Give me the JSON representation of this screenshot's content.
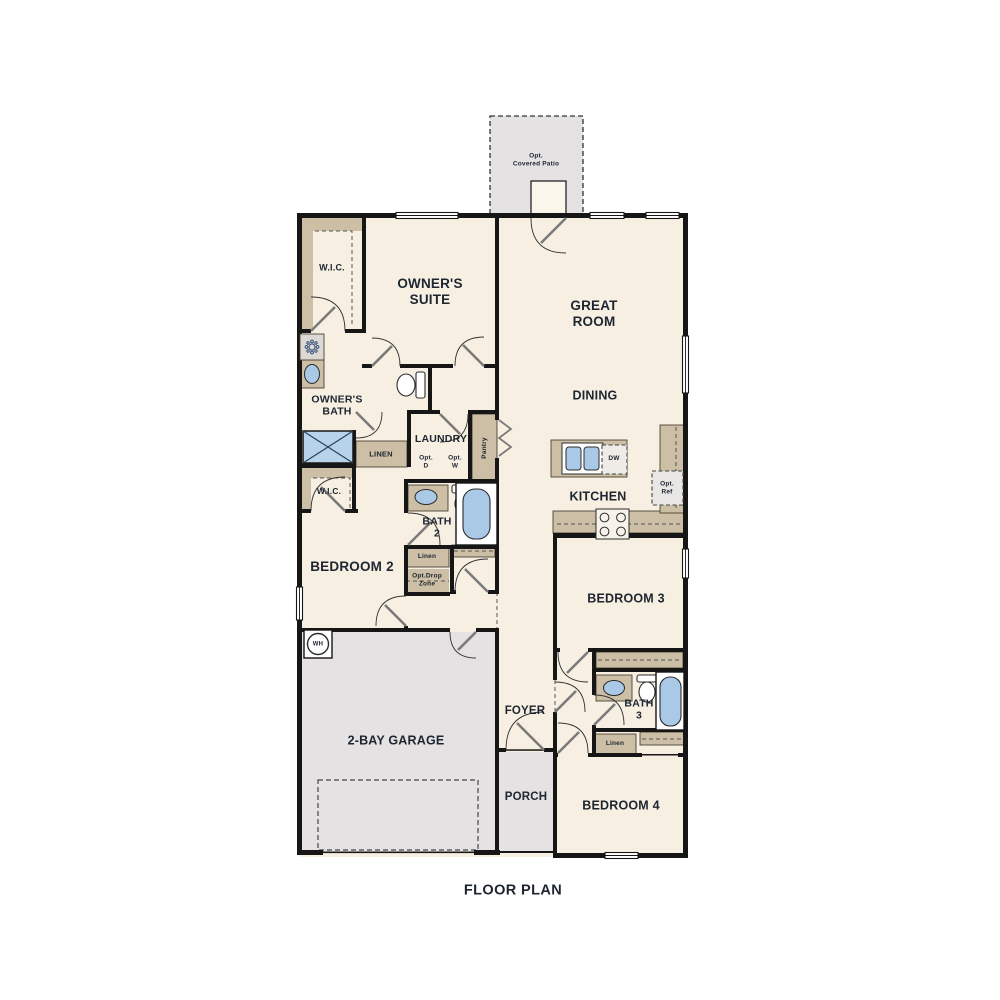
{
  "title": "FLOOR PLAN",
  "colors": {
    "wall": "#161616",
    "floor": "#f7f0e2",
    "concrete": "#e4e2e2",
    "cabinet": "#ccbfa5",
    "fixture_blue": "#a9c9e7",
    "label_text": "#1d2531",
    "door_swing": "#7a7a7a"
  },
  "rooms": {
    "patio": "Opt.\nCovered Patio",
    "wic1": "W.I.C.",
    "owners_suite": "OWNER'S\nSUITE",
    "great_room": "GREAT\nROOM",
    "owners_bath": "OWNER'S\nBATH",
    "dining": "DINING",
    "laundry": "LAUNDRY",
    "opt_d": "Opt.\nD",
    "opt_w": "Opt.\nW",
    "pantry": "Pantry",
    "linen_hall": "LINEN",
    "dw": "DW",
    "opt_ref": "Opt.\nRef",
    "kitchen": "KITCHEN",
    "wic2": "W.I.C.",
    "bath2": "BATH\n2",
    "bedroom2": "BEDROOM 2",
    "linen2": "Linen",
    "opt_drop": "Opt.Drop\nZone",
    "bedroom3": "BEDROOM 3",
    "wh": "WH",
    "garage": "2-BAY GARAGE",
    "foyer": "FOYER",
    "bath3": "BATH\n3",
    "linen3": "Linen",
    "porch": "PORCH",
    "bedroom4": "BEDROOM 4"
  },
  "icons": {
    "shower_head": "shower-head-icon",
    "shower_pan": "shower-x-icon",
    "toilet": "toilet-icon",
    "bathtub": "bathtub-icon",
    "sink": "sink-icon",
    "double_sink": "kitchen-double-sink-icon",
    "range": "range-burners-icon",
    "water_heater": "water-heater-icon",
    "window": "window-symbol",
    "door": "door-swing"
  }
}
